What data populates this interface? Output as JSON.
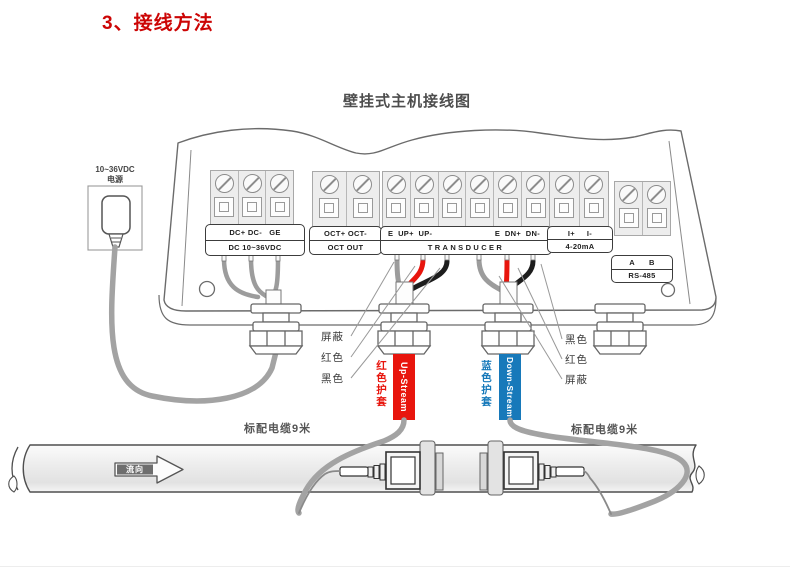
{
  "page": {
    "section_title": "3、接线方法",
    "diagram_title": "壁挂式主机接线图"
  },
  "power_supply": {
    "line1": "10~36VDC",
    "line2": "电源"
  },
  "terminals": {
    "dc": {
      "row1": "DC+ DC-   GE",
      "row2": "DC 10~36VDC"
    },
    "oct": {
      "row1": "OCT+ OCT-",
      "row2": "OCT OUT"
    },
    "transducer": {
      "row1_left": "E  UP+  UP-",
      "row1_right": "E  DN+  DN-",
      "row2": "TRANSDUCER"
    },
    "current_loop": {
      "row1": "I+     I-",
      "row2": "4-20mA"
    },
    "rs485": {
      "row1": "A      B",
      "row2": "RS-485"
    }
  },
  "wire_color_labels": {
    "left": [
      "屏蔽",
      "红色",
      "黑色"
    ],
    "right": [
      "黑色",
      "红色",
      "屏蔽"
    ]
  },
  "cables": {
    "upstream": {
      "sheath": "红色护套",
      "tag": "Up-Stream",
      "color": "#e8150d"
    },
    "downstream": {
      "sheath": "蓝色护套",
      "tag": "Down-Stream",
      "color": "#1779ba"
    },
    "left_note": "标配电缆9米",
    "right_note": "标配电缆9米"
  },
  "pipe": {
    "flow": "流向"
  },
  "colors": {
    "title_red": "#cc0505",
    "cable_red": "#e8150d",
    "cable_blue": "#1779ba"
  }
}
